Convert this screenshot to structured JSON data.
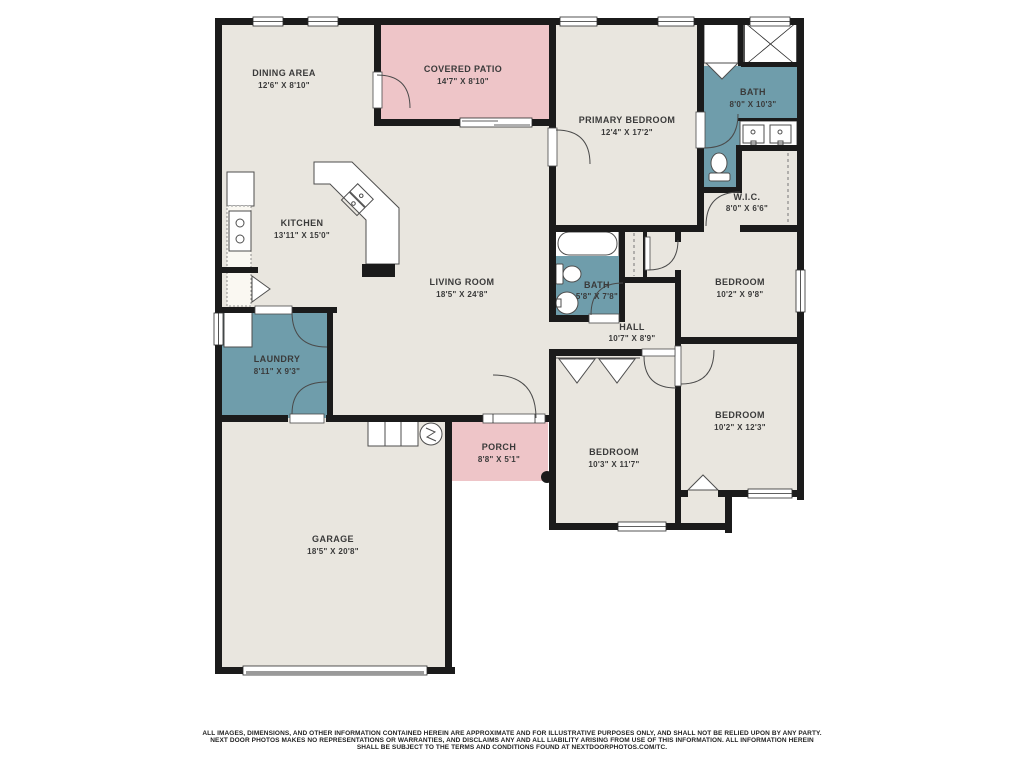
{
  "palette": {
    "wall": "#1b1b1b",
    "floor": "#e9e6df",
    "wet_rooms": "#6f9dab",
    "outdoor": "#eec5c8",
    "label_text": "#3a3a3a",
    "background": "#ffffff"
  },
  "rooms": {
    "dining": {
      "name": "DINING AREA",
      "dims": "12'6\" X 8'10\""
    },
    "patio": {
      "name": "COVERED PATIO",
      "dims": "14'7\" X 8'10\""
    },
    "primary_bedroom": {
      "name": "PRIMARY BEDROOM",
      "dims": "12'4\" X 17'2\""
    },
    "bath_primary": {
      "name": "BATH",
      "dims": "8'0\" X 10'3\""
    },
    "wic": {
      "name": "W.I.C.",
      "dims": "8'0\" X 6'6\""
    },
    "kitchen": {
      "name": "KITCHEN",
      "dims": "13'11\" X 15'0\""
    },
    "living": {
      "name": "LIVING ROOM",
      "dims": "18'5\" X 24'8\""
    },
    "bath_hall": {
      "name": "BATH",
      "dims": "5'8\" X 7'8\""
    },
    "hall": {
      "name": "HALL",
      "dims": "10'7\" X 8'9\""
    },
    "bedroom_ne": {
      "name": "BEDROOM",
      "dims": "10'2\" X 9'8\""
    },
    "laundry": {
      "name": "LAUNDRY",
      "dims": "8'11\" X 9'3\""
    },
    "bedroom_se": {
      "name": "BEDROOM",
      "dims": "10'2\" X 12'3\""
    },
    "bedroom_s": {
      "name": "BEDROOM",
      "dims": "10'3\" X 11'7\""
    },
    "porch": {
      "name": "PORCH",
      "dims": "8'8\" X 5'1\""
    },
    "garage": {
      "name": "GARAGE",
      "dims": "18'5\" X 20'8\""
    }
  },
  "disclaimer": {
    "line1": "ALL IMAGES, DIMENSIONS, AND OTHER INFORMATION CONTAINED HEREIN ARE APPROXIMATE AND FOR ILLUSTRATIVE PURPOSES ONLY, AND SHALL NOT BE RELIED UPON BY ANY PARTY.",
    "line2": "NEXT DOOR PHOTOS MAKES NO REPRESENTATIONS OR WARRANTIES, AND DISCLAIMS ANY AND ALL LIABILITY ARISING FROM USE OF THIS INFORMATION. ALL INFORMATION HEREIN",
    "line3": "SHALL BE SUBJECT TO THE TERMS AND CONDITIONS FOUND AT NEXTDOORPHOTOS.COM/TC."
  }
}
